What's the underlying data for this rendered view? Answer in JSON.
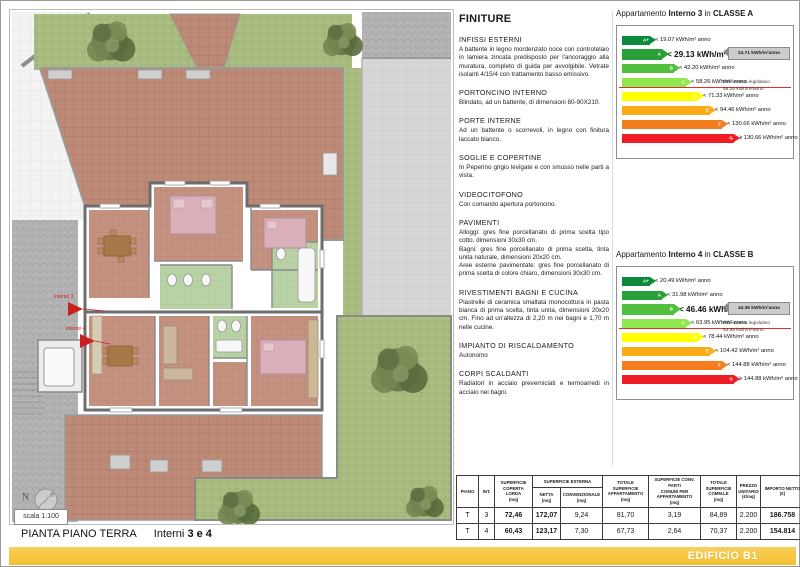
{
  "plan": {
    "labels": {
      "interno3": "interno 3",
      "interno4": "interno 4",
      "north": "N",
      "scale": "scala 1:100"
    }
  },
  "colors": {
    "terracotta": "#bd8a77",
    "grass": "#a9bc80",
    "paving_gray": "#d6d6d6",
    "bath_green": "#b9d2a6",
    "bedroom_pink": "#d9b0ba",
    "annotation_red": "#cc2020",
    "reference_red": "#e03127",
    "callout_gray": "#cccccc",
    "banner_yellow": "#f4bf2e",
    "banner_yellow_light": "#f8cf5a"
  },
  "finiture": {
    "title": "FINITURE",
    "sections": [
      {
        "heading": "INFISSI ESTERNI",
        "body": "A battente in legno mordenzato noce con controtelaio in lamiera zincata predisposto per l'ancoraggio alla muratura, completo di guida per avvolgibile. Vetrate isolanti 4/15/4 con trattamento basso emissivo."
      },
      {
        "heading": "PORTONCINO INTERNO",
        "body": "Blindato, ad un battente, di dimensioni 80-90X210."
      },
      {
        "heading": "PORTE INTERNE",
        "body": "Ad un battente o scorrevoli, in legno con finitura laccato bianco."
      },
      {
        "heading": "SOGLIE E COPERTINE",
        "body": "In Peperino grigio levigate e con smusso nelle parti a vista."
      },
      {
        "heading": "VIDEOCITOFONO",
        "body": "Con comando apertura portoncino."
      },
      {
        "heading": "PAVIMENTI",
        "body": "Alloggi: gres fine porcellanato di prima scelta tipo cotto, dimensioni 30x30 cm.\nBagni: gres fine porcellanato di prima scelta, tinta unita naturale, dimensioni 20x20 cm.\nAree esterne pavimentate: gres fine porcellanato di prima scelta di colore chiaro, dimensioni 30x30 cm."
      },
      {
        "heading": "RIVESTIMENTI BAGNI E CUCINA",
        "body": "Piastrelle di ceramica smaltata monocottura in pasta bianca di prima scelta, tinta unita, dimensioni 20x20 cm. Fino ad un'altezza di 2,20 m nei bagni e 1,70 m nelle cucine."
      },
      {
        "heading": "IMPIANTO DI RISCALDAMENTO",
        "body": "Autonomo"
      },
      {
        "heading": "CORPI SCALDANTI",
        "body": "Radiatori in acciaio preverniciati e termoarredi in acciaio nei bagni."
      }
    ]
  },
  "energy_charts": [
    {
      "title": {
        "prefix": "Appartamento",
        "apartment": "Interno 3",
        "connector": "in",
        "class_label": "CLASSE A"
      },
      "current_value": "24.71 kWh/m²anno",
      "reference": {
        "label": "Riferimento legislativo",
        "value": "58.26 kWh/m²anno"
      },
      "highlight_index": 1,
      "reference_index": 3,
      "bars": [
        {
          "class": "A+",
          "color": "#0d8a3c",
          "label": "< 19.07 kWh/m² anno"
        },
        {
          "class": "A",
          "color": "#29a038",
          "label": "< 29.13 kWh/m² anno"
        },
        {
          "class": "B",
          "color": "#50bf3e",
          "label": "< 42.20 kWh/m² anno"
        },
        {
          "class": "C",
          "color": "#8fe84f",
          "label": "< 58.26 kWh/m² anno"
        },
        {
          "class": "D",
          "color": "#ffff00",
          "label": "< 71.33 kWh/m² anno"
        },
        {
          "class": "E",
          "color": "#fbab18",
          "label": "< 94.46 kWh/m² anno"
        },
        {
          "class": "F",
          "color": "#f47d20",
          "label": "< 130.66 kWh/m² anno"
        },
        {
          "class": "G",
          "color": "#ee1c25",
          "label": "≥ 130.66 kWh/m² anno"
        }
      ]
    },
    {
      "title": {
        "prefix": "Appartamento",
        "apartment": "Interno 4",
        "connector": "in",
        "class_label": "CLASSE B"
      },
      "current_value": "44.36 kWh/m²anno",
      "reference": {
        "label": "Riferimento legislativo",
        "value": "63.95 kWh/m²anno"
      },
      "highlight_index": 2,
      "reference_index": 3,
      "bars": [
        {
          "class": "A+",
          "color": "#0d8a3c",
          "label": "< 20.49 kWh/m² anno"
        },
        {
          "class": "A",
          "color": "#29a038",
          "label": "< 31.98 kWh/m² anno"
        },
        {
          "class": "B",
          "color": "#50bf3e",
          "label": "< 46.46 kWh/m² anno"
        },
        {
          "class": "C",
          "color": "#8fe84f",
          "label": "< 63.95 kWh/m² anno"
        },
        {
          "class": "D",
          "color": "#ffff00",
          "label": "< 78.44 kWh/m² anno"
        },
        {
          "class": "E",
          "color": "#fbab18",
          "label": "< 104.42 kWh/m² anno"
        },
        {
          "class": "F",
          "color": "#f47d20",
          "label": "< 144.88 kWh/m² anno"
        },
        {
          "class": "G",
          "color": "#ee1c25",
          "label": "≥ 144.88 kWh/m² anno"
        }
      ]
    }
  ],
  "table": {
    "headers": {
      "piano": "PIANO",
      "int": "INT.",
      "coperta": "SUPERFICIE\nCOPERTA LORDA\n(mq)",
      "esterna": "SUPERFICIE ESTERNA",
      "netta": "NETTA\n(mq)",
      "convenzionale": "CONVENZIONALE (mq)",
      "totale_app": "TOTALE SUPERFICIE\nAPPARTAMENTO\n(mq)",
      "conv_comuni": "SUPERFICIE CONV. PARTI\nCOMUNI PER\nAPPARTAMENTO\n(mq)",
      "totale_comm": "TOTALE\nSUPERFICIE\nCOMM.LE\n(mq)",
      "prezzo": "PREZZO\nUNITARIO\n(€/mq)",
      "importo": "IMPORTO NETTO\n(€)"
    },
    "rows": [
      [
        "T",
        "3",
        "72,46",
        "172,07",
        "9,24",
        "81,70",
        "3,19",
        "84,89",
        "2.200",
        "186.758"
      ],
      [
        "T",
        "4",
        "60,43",
        "123,17",
        "7,30",
        "67,73",
        "2,64",
        "70,37",
        "2.200",
        "154.814"
      ]
    ],
    "bold_columns": [
      2,
      3,
      9
    ]
  },
  "footer": {
    "plan_title": "PIANTA PIANO TERRA",
    "plan_subtitle_prefix": "Interni",
    "plan_subtitle_bold": "3 e 4",
    "banner": "EDIFICIO B1"
  }
}
